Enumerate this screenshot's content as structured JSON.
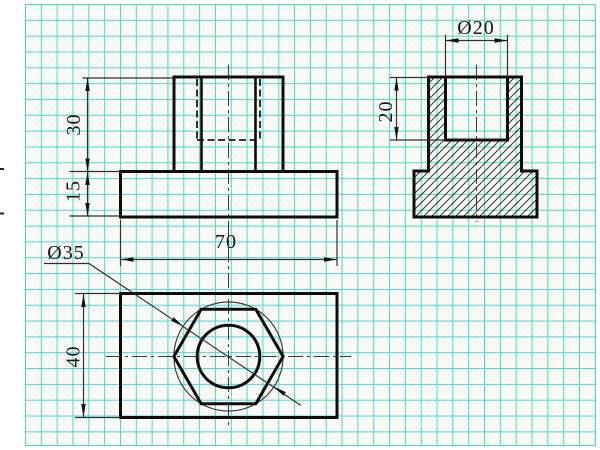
{
  "drawing": {
    "kind": "three-view orthographic technical drawing on graph paper",
    "dimensions": {
      "boss_height": "30",
      "base_thickness": "15",
      "base_width": "70",
      "hex_circle_diameter": "Ø35",
      "base_depth": "40",
      "hole_diameter": "Ø20",
      "hole_depth": "20"
    },
    "colors": {
      "grid": "#4bd6cc",
      "paper": "#fafaf5",
      "outline": "#0d0d0d",
      "thin_line": "#2f2f2f"
    }
  }
}
